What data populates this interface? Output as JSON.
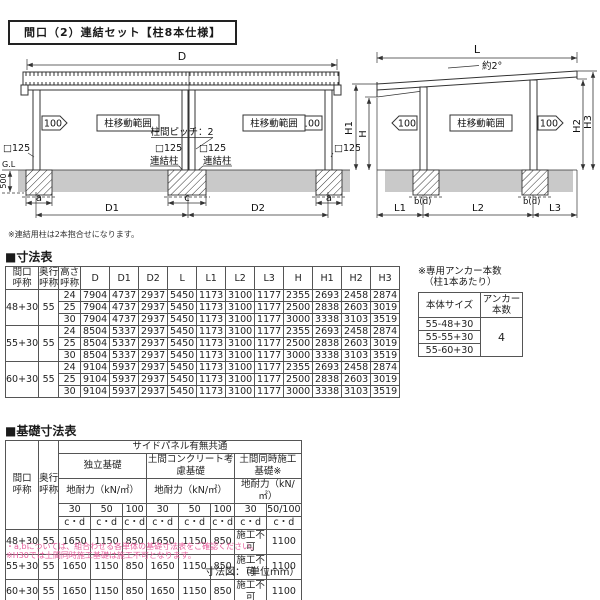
{
  "title": "間口（2）連結セット【柱8本仕様】",
  "diagram_note": "※連結用柱は2本抱合せになります。",
  "unit_note": "寸法図：（単位mm）",
  "front_view": {
    "dim_d": "D",
    "dim_d1": "D1",
    "dim_d2": "D2",
    "dim_a_left": "a",
    "dim_c": "c",
    "dim_a_right": "a",
    "dim_h": "H",
    "dim_h1": "H1",
    "dim_500": "500",
    "gl": "G.L",
    "arrow_left": "100",
    "arrow_right": "100",
    "move_range_left": "柱移動範囲",
    "move_range_right": "柱移動範囲",
    "pitch_label": "柱間ピッチ：2",
    "sq_left": "□125",
    "sq_center_left": "□125",
    "sq_center_right": "□125",
    "sq_right": "□125",
    "link_post_left": "連結柱",
    "link_post_right": "連結柱"
  },
  "side_view": {
    "dim_l": "L",
    "slope": "約2°",
    "dim_l1": "L1",
    "dim_l2": "L2",
    "dim_l3": "L3",
    "dim_h2": "H2",
    "dim_h3": "H3",
    "arrow_left": "100",
    "arrow_right": "100",
    "move_range": "柱移動範囲",
    "bd_left": "b(d)",
    "bd_right": "b(d)"
  },
  "dim_table": {
    "heading": "■寸法表",
    "headers": [
      "間口\n呼称",
      "奥行\n呼称",
      "高さ\n呼称",
      "D",
      "D1",
      "D2",
      "L",
      "L1",
      "L2",
      "L3",
      "H",
      "H1",
      "H2",
      "H3"
    ],
    "groups": [
      {
        "width": "48+30",
        "depth": "55",
        "rows": [
          [
            "24",
            "7904",
            "4737",
            "2937",
            "5450",
            "1173",
            "3100",
            "1177",
            "2355",
            "2693",
            "2458",
            "2874"
          ],
          [
            "25",
            "7904",
            "4737",
            "2937",
            "5450",
            "1173",
            "3100",
            "1177",
            "2500",
            "2838",
            "2603",
            "3019"
          ],
          [
            "30",
            "7904",
            "4737",
            "2937",
            "5450",
            "1173",
            "3100",
            "1177",
            "3000",
            "3338",
            "3103",
            "3519"
          ]
        ]
      },
      {
        "width": "55+30",
        "depth": "55",
        "rows": [
          [
            "24",
            "8504",
            "5337",
            "2937",
            "5450",
            "1173",
            "3100",
            "1177",
            "2355",
            "2693",
            "2458",
            "2874"
          ],
          [
            "25",
            "8504",
            "5337",
            "2937",
            "5450",
            "1173",
            "3100",
            "1177",
            "2500",
            "2838",
            "2603",
            "3019"
          ],
          [
            "30",
            "8504",
            "5337",
            "2937",
            "5450",
            "1173",
            "3100",
            "1177",
            "3000",
            "3338",
            "3103",
            "3519"
          ]
        ]
      },
      {
        "width": "60+30",
        "depth": "55",
        "rows": [
          [
            "24",
            "9104",
            "5937",
            "2937",
            "5450",
            "1173",
            "3100",
            "1177",
            "2355",
            "2693",
            "2458",
            "2874"
          ],
          [
            "25",
            "9104",
            "5937",
            "2937",
            "5450",
            "1173",
            "3100",
            "1177",
            "2500",
            "2838",
            "2603",
            "3019"
          ],
          [
            "30",
            "9104",
            "5937",
            "2937",
            "5450",
            "1173",
            "3100",
            "1177",
            "3000",
            "3338",
            "3103",
            "3519"
          ]
        ]
      }
    ]
  },
  "anchor_table": {
    "note_line1": "※専用アンカー本数",
    "note_line2": "（柱1本あたり）",
    "header_size": "本体サイズ",
    "header_count": "アンカー\n本数",
    "rows": [
      "55-48+30",
      "55-55+30",
      "55-60+30"
    ],
    "count": "4"
  },
  "foundation_table": {
    "heading": "■基礎寸法表",
    "top_header": "サイドパネル有無共通",
    "col_width": "間口\n呼称",
    "col_depth": "奥行\n呼称",
    "group_headers": [
      "独立基礎",
      "土間コンクリート考慮基礎",
      "土間同時施工基礎※"
    ],
    "subheader": "地耐力（kN/㎡）",
    "loads": [
      "30",
      "50",
      "100",
      "30",
      "50",
      "100",
      "30",
      "50/100"
    ],
    "cd": "c・d",
    "rows": [
      {
        "width": "48+30",
        "depth": "55",
        "values": [
          "1650",
          "1150",
          "850",
          "1650",
          "1150",
          "850",
          "施工不可",
          "1100"
        ]
      },
      {
        "width": "55+30",
        "depth": "55",
        "values": [
          "1650",
          "1150",
          "850",
          "1650",
          "1150",
          "850",
          "施工不可",
          "1100"
        ]
      },
      {
        "width": "60+30",
        "depth": "55",
        "values": [
          "1650",
          "1150",
          "850",
          "1650",
          "1150",
          "850",
          "施工不可",
          "1100"
        ]
      }
    ],
    "notes": [
      "・a,bについては、組合わせる各単体の基礎寸法表をご確認ください。",
      "※H30では土間同時施工基礎は施工不可となります。"
    ]
  }
}
